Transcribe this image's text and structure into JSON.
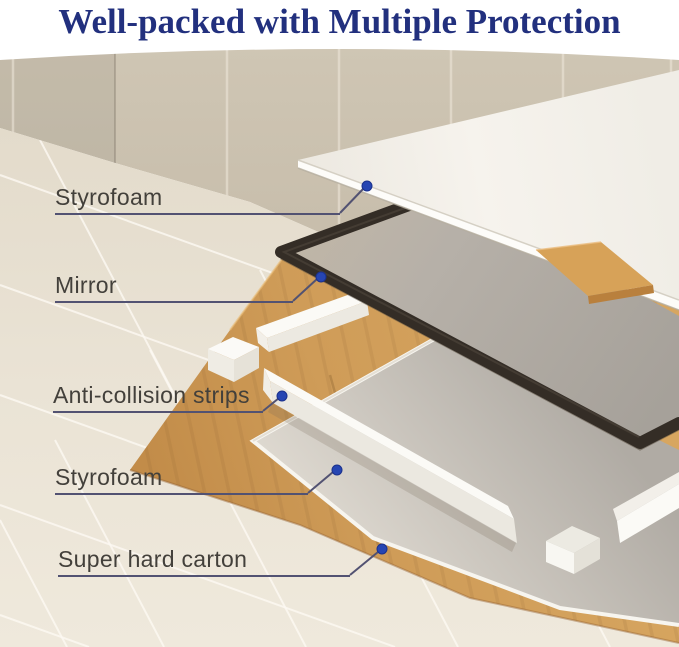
{
  "page": {
    "title": "Well-packed with Multiple Protection"
  },
  "callouts": [
    {
      "id": "styrofoam-top",
      "text": "Styrofoam"
    },
    {
      "id": "mirror",
      "text": "Mirror"
    },
    {
      "id": "anti-collision-strips",
      "text": "Anti-collision strips"
    },
    {
      "id": "styrofoam-bottom",
      "text": "Styrofoam"
    },
    {
      "id": "super-hard-carton",
      "text": "Super hard carton"
    }
  ],
  "theme": {
    "title_color": "#22307e",
    "label_color": "#43403b",
    "leader_line_color": "#525272",
    "dot_color": "#2645b2",
    "wall_tile_color": "#c9bfad",
    "floor_tile_color": "#e9e2d4",
    "carton_color": "#cd9a55",
    "styrofoam_color": "#f2efe8",
    "mirror_frame_color": "#342d26",
    "mirror_glass_color": "#b2ada6"
  }
}
